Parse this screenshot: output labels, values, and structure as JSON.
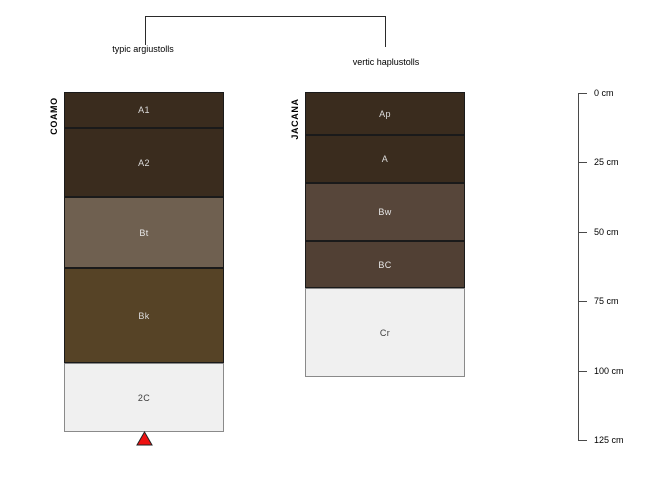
{
  "figure": {
    "type": "soil-profile-diagram",
    "background": "#ffffff",
    "depth_axis_unit": "cm"
  },
  "bracket": {
    "left_label": "typic argiustolls",
    "right_label": "vertic haplustolls",
    "line_color": "#2a2a2a"
  },
  "profiles": [
    {
      "name": "COAMO",
      "classification": "typic argiustolls",
      "geometry": {
        "left_px": 64,
        "width_px": 160
      },
      "layers": [
        {
          "label": "A1",
          "depth_top_cm": 0,
          "depth_bottom_cm": 13,
          "color": "#3a2c1e",
          "border_color": "#1a1a1a",
          "text_color": "#dcdcdc",
          "top_px": 92,
          "height_px": 36
        },
        {
          "label": "A2",
          "depth_top_cm": 13,
          "depth_bottom_cm": 38,
          "color": "#3a2c1e",
          "border_color": "#1a1a1a",
          "text_color": "#dcdcdc",
          "top_px": 128,
          "height_px": 69
        },
        {
          "label": "Bt",
          "depth_top_cm": 38,
          "depth_bottom_cm": 63,
          "color": "#6f6050",
          "border_color": "#1a1a1a",
          "text_color": "#e8e8e8",
          "top_px": 197,
          "height_px": 71
        },
        {
          "label": "Bk",
          "depth_top_cm": 63,
          "depth_bottom_cm": 97,
          "color": "#564326",
          "border_color": "#1a1a1a",
          "text_color": "#dcdcdc",
          "top_px": 268,
          "height_px": 95
        },
        {
          "label": "2C",
          "depth_top_cm": 97,
          "depth_bottom_cm": 122,
          "color": "#f0f0f0",
          "border_color": "#8a8a8a",
          "text_color": "#3c3c3c",
          "top_px": 363,
          "height_px": 69
        }
      ]
    },
    {
      "name": "JACANA",
      "classification": "vertic haplustolls",
      "geometry": {
        "left_px": 305,
        "width_px": 160
      },
      "layers": [
        {
          "label": "Ap",
          "depth_top_cm": 0,
          "depth_bottom_cm": 15,
          "color": "#3a2c1e",
          "border_color": "#1a1a1a",
          "text_color": "#dcdcdc",
          "top_px": 92,
          "height_px": 43
        },
        {
          "label": "A",
          "depth_top_cm": 15,
          "depth_bottom_cm": 33,
          "color": "#3a2c1e",
          "border_color": "#1a1a1a",
          "text_color": "#dcdcdc",
          "top_px": 135,
          "height_px": 48
        },
        {
          "label": "Bw",
          "depth_top_cm": 33,
          "depth_bottom_cm": 53,
          "color": "#57463a",
          "border_color": "#1a1a1a",
          "text_color": "#e8e8e8",
          "top_px": 183,
          "height_px": 58
        },
        {
          "label": "BC",
          "depth_top_cm": 53,
          "depth_bottom_cm": 70,
          "color": "#514034",
          "border_color": "#1a1a1a",
          "text_color": "#e8e8e8",
          "top_px": 241,
          "height_px": 47
        },
        {
          "label": "Cr",
          "depth_top_cm": 70,
          "depth_bottom_cm": 102,
          "color": "#f0f0f0",
          "border_color": "#8a8a8a",
          "text_color": "#3c3c3c",
          "top_px": 288,
          "height_px": 89
        }
      ]
    }
  ],
  "depth_scale": {
    "unit": "cm",
    "line_color": "#4a4a4a",
    "ticks": [
      {
        "label": "0 cm",
        "depth_cm": 0,
        "y_px": 93
      },
      {
        "label": "25 cm",
        "depth_cm": 25,
        "y_px": 162
      },
      {
        "label": "50 cm",
        "depth_cm": 50,
        "y_px": 232
      },
      {
        "label": "75 cm",
        "depth_cm": 75,
        "y_px": 301
      },
      {
        "label": "100 cm",
        "depth_cm": 100,
        "y_px": 371
      },
      {
        "label": "125 cm",
        "depth_cm": 125,
        "y_px": 440
      }
    ]
  },
  "marker": {
    "shape": "triangle-up",
    "fill": "#ee1111",
    "outline": "#222222",
    "position": "below COAMO profile at 2C base"
  }
}
